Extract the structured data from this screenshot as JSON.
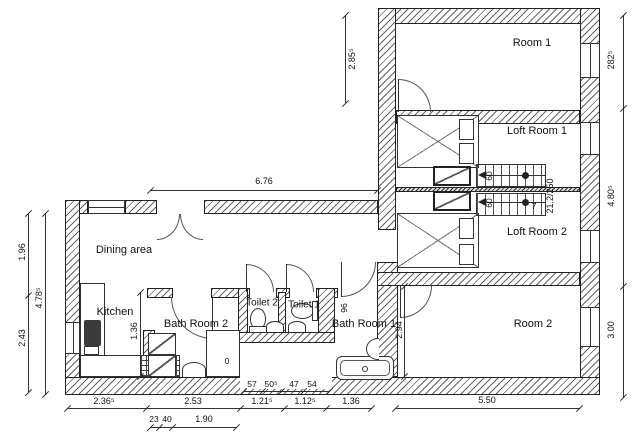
{
  "rooms": {
    "room1": "Room 1",
    "loft1": "Loft Room 1",
    "loft2": "Loft Room 2",
    "room2": "Room 2",
    "dining": "Dining area",
    "kitchen": "Kitchen",
    "bath2": "Bath Room 2",
    "toilet2": "Toilet 2",
    "toilet1": "Toilet 1",
    "bath1": "Bath Room 1"
  },
  "dims": {
    "left_upper": "1.96",
    "left_lower": "2.43",
    "left_total": "4.78⁵",
    "top_span": "6.76",
    "upper_left": "2.85⁵",
    "right_top": "282⁵",
    "right_mid": "4.80⁵",
    "right_bottom": "3.00",
    "bottom_1": "2.36⁵",
    "bottom_2": "2.53",
    "bottom_3": "1.21⁵",
    "bottom_4": "1.12⁵",
    "bottom_5": "1.36",
    "bottom_6": "5.50",
    "sub_1": "23",
    "sub_2": "40",
    "sub_3": "1.90",
    "small_1": "57",
    "small_2": "50⁵",
    "small_3": "47",
    "small_4": "54",
    "kitchen_wall": "1.36",
    "bath1_height": "2.94",
    "bath1_door": "96",
    "stair_spec": "21.2/250",
    "stair_w1": "60",
    "stair_w2": "60",
    "stair_count": "7",
    "bath2_mark": "0"
  }
}
